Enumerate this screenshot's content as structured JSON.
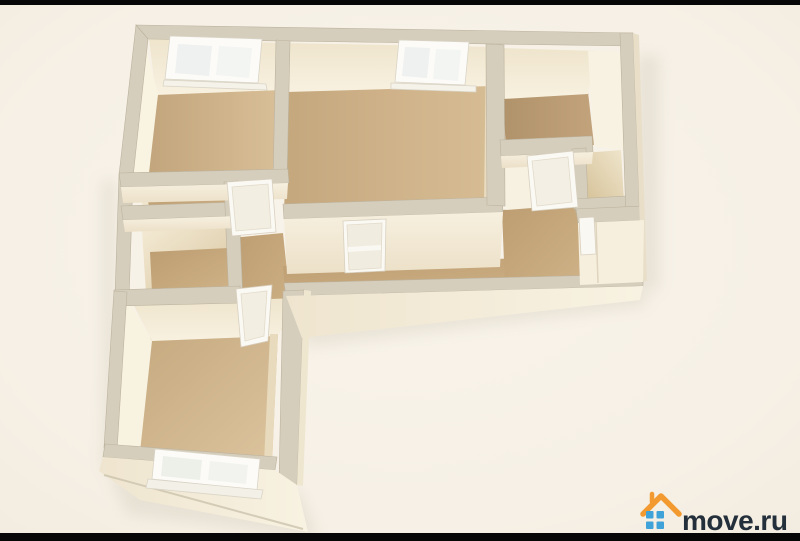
{
  "frame": {
    "letterbox_color": "#070707",
    "background_color": "#f6f0e6"
  },
  "watermark": {
    "text": "move.ru",
    "text_color": "#232f3a",
    "roof_color": "#f29a2f",
    "squares_color": "#3fa3d9"
  },
  "palette": {
    "wall_top": "#d6cebc",
    "wall_face_light": "#f7f0de",
    "wall_face_shadow": "#e3d3b2",
    "floor_wood": "#d0b489",
    "floor_wood_dark": "#b7986f",
    "window_glass": "#eef1ef",
    "door_white": "#faf8f2"
  },
  "scene": {
    "type": "3d-apartment-floor-plan",
    "windows_visible": 3,
    "doors_visible": 5
  }
}
